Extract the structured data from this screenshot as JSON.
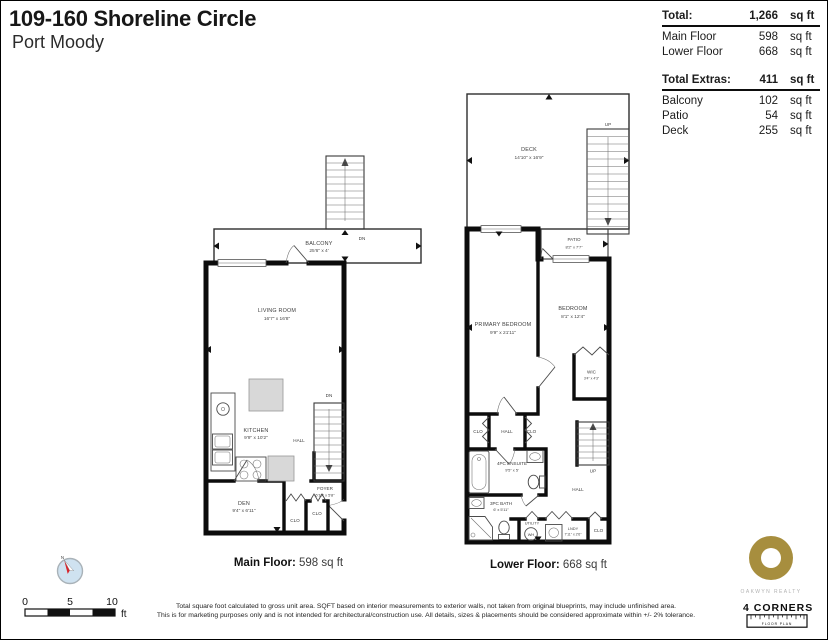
{
  "header": {
    "title": "109-160 Shoreline Circle",
    "subtitle": "Port Moody"
  },
  "area_summary": {
    "total": {
      "label": "Total:",
      "value": "1,266",
      "unit": "sq ft"
    },
    "total_rows": [
      {
        "label": "Main Floor",
        "value": "598",
        "unit": "sq ft"
      },
      {
        "label": "Lower Floor",
        "value": "668",
        "unit": "sq ft"
      }
    ],
    "extras": {
      "label": "Total Extras:",
      "value": "411",
      "unit": "sq ft"
    },
    "extras_rows": [
      {
        "label": "Balcony",
        "value": "102",
        "unit": "sq ft"
      },
      {
        "label": "Patio",
        "value": "54",
        "unit": "sq ft"
      },
      {
        "label": "Deck",
        "value": "255",
        "unit": "sq ft"
      }
    ]
  },
  "main_floor": {
    "caption": {
      "label": "Main Floor:",
      "value": "598 sq ft"
    },
    "labels": {
      "balcony_name": "BALCONY",
      "balcony_dims": "25'6\" x 4'",
      "dn_balcony": "DN",
      "dn_stairs": "DN",
      "living_name": "LIVING ROOM",
      "living_dims": "16'7\" x 16'8\"",
      "kitchen_name": "KITCHEN",
      "kitchen_dims": "9'9\" x 10'2\"",
      "hall": "HALL",
      "den_name": "DEN",
      "den_dims": "9'4\" x 6'11\"",
      "foyer_name": "FOYER",
      "foyer_dims": "6'10\" x 5'8\"",
      "clo_a": "CLO",
      "clo_b": "CLO"
    }
  },
  "lower_floor": {
    "caption": {
      "label": "Lower Floor:",
      "value": "668 sq ft"
    },
    "labels": {
      "deck_name": "DECK",
      "deck_dims": "14'10\" x 16'9\"",
      "up_deck": "UP",
      "up_stairs": "UP",
      "patio_name": "PATIO",
      "patio_dims": "8'2\" x 7'7\"",
      "primary_name": "PRIMARY BEDROOM",
      "primary_dims": "9'9\" x 21'11\"",
      "bedroom_name": "BEDROOM",
      "bedroom_dims": "8'1\" x 12'4\"",
      "wic_name": "WIC",
      "wic_dims": "3'4\" x 4'3\"",
      "clo_a": "CLO",
      "clo_b": "CLO",
      "clo_c": "CLO",
      "hall_a": "HALL",
      "hall_b": "HALL",
      "ensuite_name": "4PC ENSUITE",
      "ensuite_dims": "9'5\" x 5'",
      "bath_name": "3PC BATH",
      "bath_dims": "6' x 5'11\"",
      "utility": "UTILITY",
      "wh": "WH",
      "lndy_name": "LNDY",
      "lndy_dims": "7'11\" x 2'6\""
    }
  },
  "scale_bar": {
    "t0": "0",
    "t5": "5",
    "t10": "10",
    "unit": "ft"
  },
  "compass": {
    "north_label": "N"
  },
  "footer": {
    "line1": "Total square foot calculated to gross unit area. SQFT based on interior measurements to exterior walls, not taken from original blueprints, may include unfinished area.",
    "line2": "This is for marketing purposes only and is not intended for architectural/construction use.  All details, sizes & placements should be considered approximate within +/- 2%  tolerance."
  },
  "branding": {
    "realty": "OAKWYN REALTY",
    "brand": "4 CORNERS",
    "brand_sub": "FLOOR PLAN",
    "gold": "#a78e3e"
  }
}
